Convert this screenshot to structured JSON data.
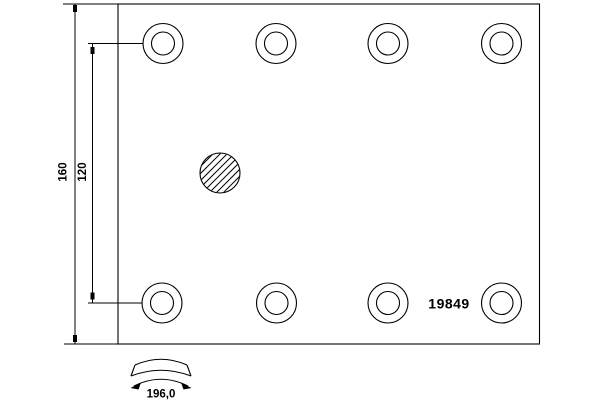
{
  "drawing": {
    "type": "brake-lining-technical-drawing",
    "part_number": "19849",
    "dimensions": {
      "total_height": {
        "value": "160",
        "orientation": "vertical"
      },
      "rivet_row_spacing": {
        "value": "120",
        "orientation": "vertical"
      },
      "arc_width": {
        "value": "196,0",
        "orientation": "horizontal"
      }
    },
    "features": {
      "rivet_hole_count": 8,
      "rivet_rows": 2,
      "rivet_holes_per_row": 4,
      "center_hole": "hatched-circle",
      "curvature_symbol": "curved-band-with-arc-dimension"
    },
    "colors": {
      "line": "#000000",
      "background": "#ffffff",
      "text": "#000000"
    }
  }
}
